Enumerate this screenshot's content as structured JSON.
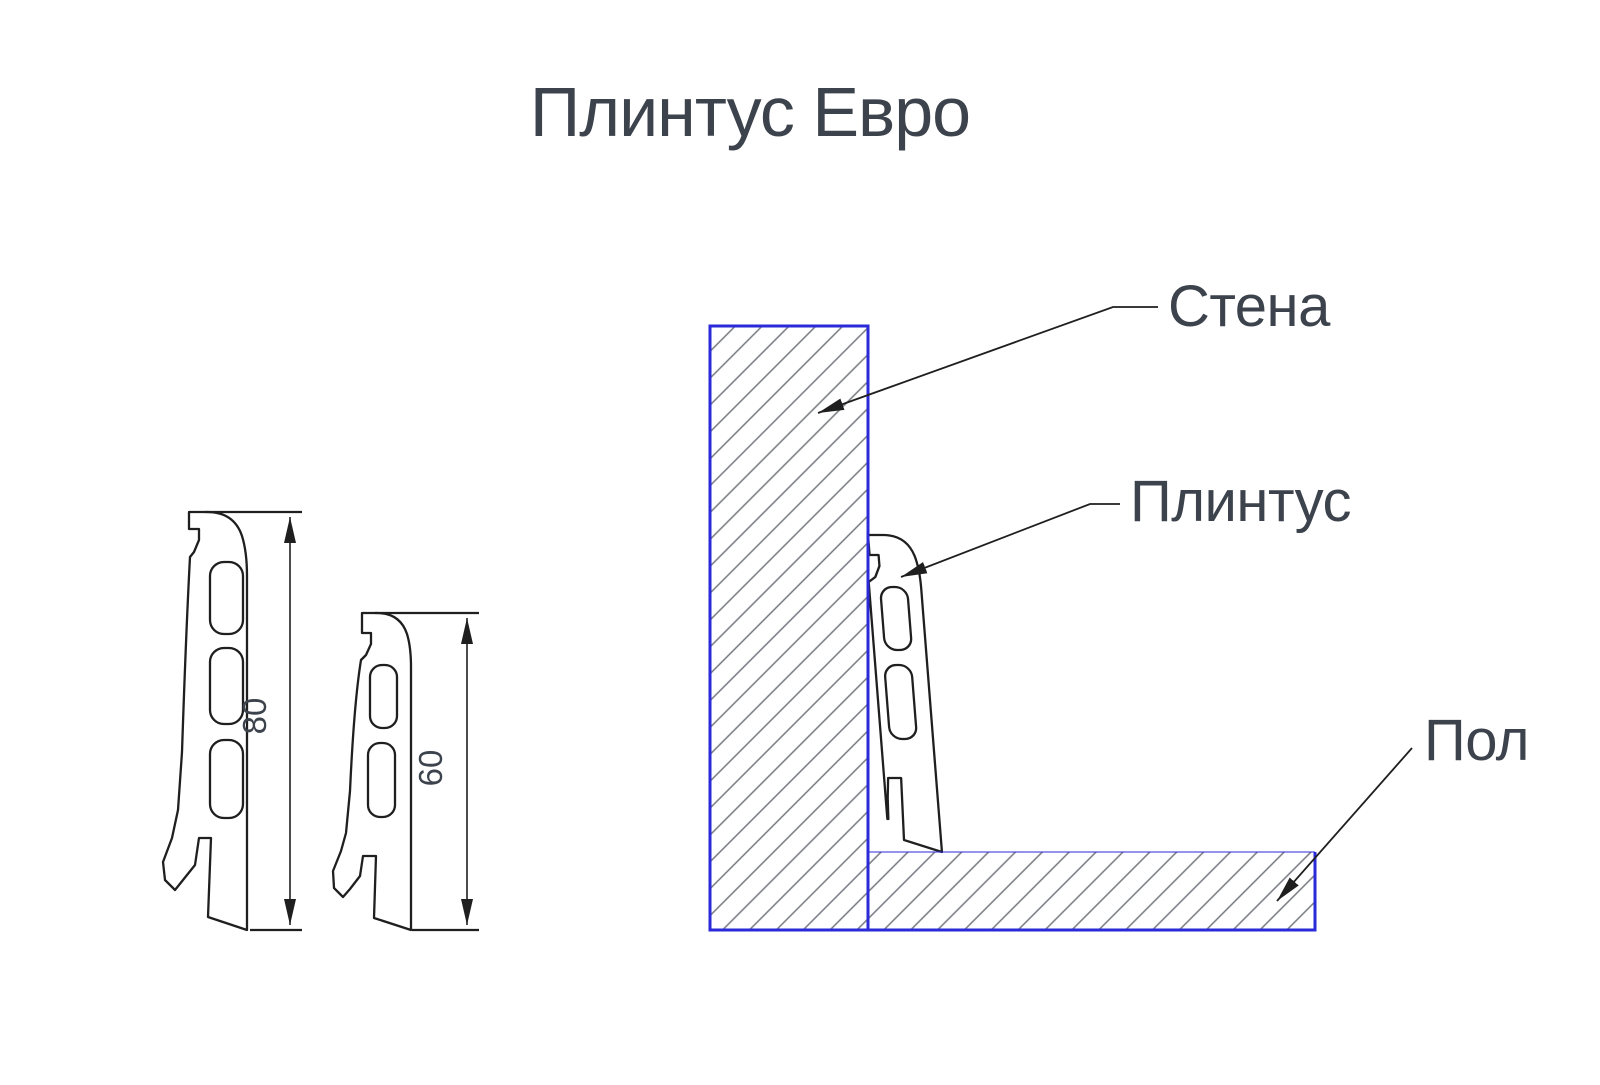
{
  "title": "Плинтус Евро",
  "left_profiles": {
    "profile_80": {
      "dimension": "80"
    },
    "profile_60": {
      "dimension": "60"
    }
  },
  "installation": {
    "wall_label": "Стена",
    "skirting_label": "Плинтус",
    "floor_label": "Пол"
  },
  "colors": {
    "diagram_blue": "#2a2ad8",
    "drawing_black": "#1f1f1f",
    "hatch_gray": "#75797f",
    "text_dark": "#3d434c",
    "background": "#ffffff"
  }
}
